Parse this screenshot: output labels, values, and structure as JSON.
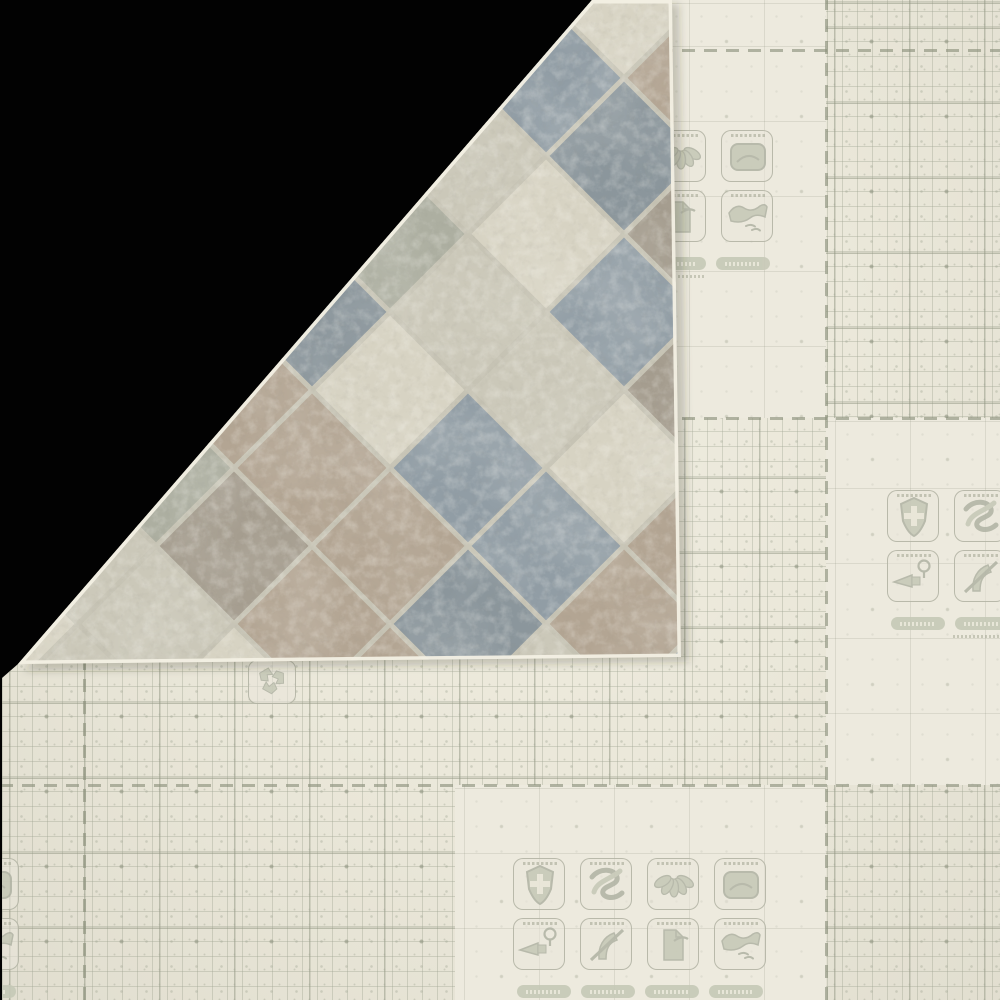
{
  "photo": {
    "subject": "folded-corner-flooring-sheet",
    "legible_text_present": false
  },
  "colors": {
    "backdrop": "#020202",
    "backing": "#ebe8da",
    "backing_plain": "#edeade",
    "grid_fine": "rgba(158,164,146,0.38)",
    "grid_fine_faint": "rgba(158,164,146,0.16)",
    "grid_medium": "rgba(141,146,126,0.5)",
    "grid_medium_faint": "rgba(141,146,126,0.2)",
    "grid_heavy": "rgba(140,145,124,0.75)",
    "print": "rgba(171,174,158,0.8)",
    "print_dark": "#a6a996",
    "box_fill": "rgba(233,230,218,0.55)",
    "pill": "#c6c9b7",
    "pill_text": "#ebe9db",
    "glyph": "#c3c6b4",
    "glyph_stroke": "#acafa0"
  },
  "flap": {
    "grout_color": "#c6c3b4",
    "edge_color": "#f3f0e4",
    "palette": [
      "#cbc8b9",
      "#b3a593",
      "#919da5",
      "#a59d8f",
      "#adafa1",
      "#d7d3c3",
      "#8b969c"
    ],
    "rows": [
      [
        5,
        1,
        0,
        2,
        5
      ],
      [
        0,
        2,
        4,
        2,
        1
      ],
      [
        1,
        5,
        2,
        0,
        6
      ],
      [
        2,
        0,
        4,
        5,
        3
      ],
      [
        4,
        1,
        6,
        0,
        2
      ],
      [
        3,
        1,
        5,
        0,
        3
      ],
      [
        0,
        4,
        1,
        2,
        5
      ],
      [
        0,
        3,
        1,
        2,
        1
      ],
      [
        5,
        0,
        1,
        6,
        1
      ],
      [
        0,
        5,
        1,
        0,
        2
      ]
    ]
  },
  "icon_clusters": {
    "icons": [
      {
        "name": "shield-cross-icon",
        "glyph": "shield"
      },
      {
        "name": "knotted-rope-icon",
        "glyph": "knot"
      },
      {
        "name": "leaf-petals-icon",
        "glyph": "petals"
      },
      {
        "name": "cushion-comfort-icon",
        "glyph": "cushion"
      },
      {
        "name": "adhesive-applicator-icon",
        "glyph": "gun"
      },
      {
        "name": "no-stiletto-heel-icon",
        "glyph": "heel"
      },
      {
        "name": "folded-sheet-icon",
        "glyph": "canister"
      },
      {
        "name": "hand-fabric-icon",
        "glyph": "hand"
      }
    ],
    "badges_per_cluster": 4,
    "badge_labels_legible": false,
    "caption_labels_legible": false
  },
  "recycle": {
    "name": "recycle-icon",
    "glyph": "recycle"
  }
}
